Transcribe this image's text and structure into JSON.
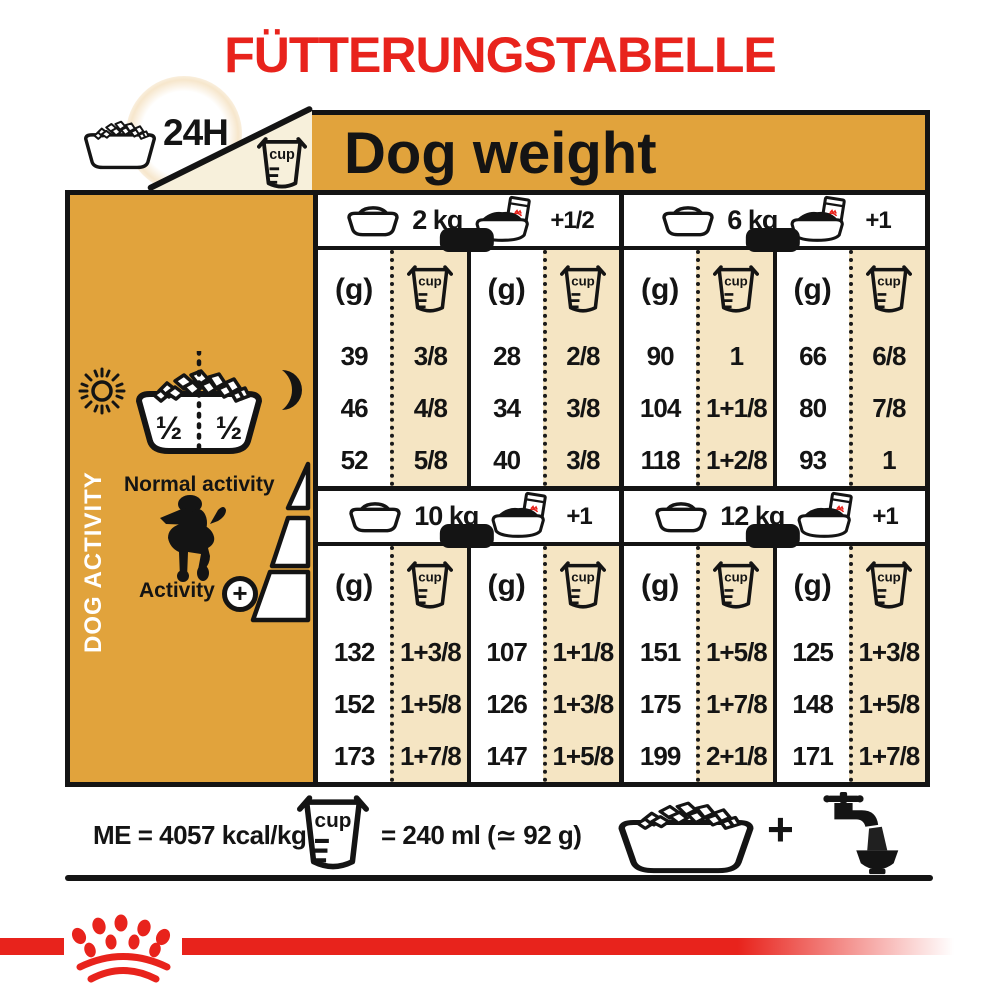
{
  "title": "FÜTTERUNGSTABELLE",
  "header": {
    "daily_label": "24H",
    "dog_weight_label": "Dog weight"
  },
  "icons": {
    "cup_text": "cup"
  },
  "sidebar": {
    "title": "DOG ACTIVITY",
    "bowl_half_left": "½",
    "bowl_half_right": "½",
    "normal_activity_label": "Normal activity",
    "activity_label": "Activity",
    "activity_plus": "+"
  },
  "table": {
    "grams_header": "(g)",
    "groups": [
      {
        "weight": "2 kg",
        "wet_add": "+1/2",
        "dry_g": [
          "39",
          "46",
          "52"
        ],
        "dry_cup": [
          "3/8",
          "4/8",
          "5/8"
        ],
        "mix_g": [
          "28",
          "34",
          "40"
        ],
        "mix_cup": [
          "2/8",
          "3/8",
          "3/8"
        ]
      },
      {
        "weight": "6 kg",
        "wet_add": "+1",
        "dry_g": [
          "90",
          "104",
          "118"
        ],
        "dry_cup": [
          "1",
          "1+1/8",
          "1+2/8"
        ],
        "mix_g": [
          "66",
          "80",
          "93"
        ],
        "mix_cup": [
          "6/8",
          "7/8",
          "1"
        ]
      },
      {
        "weight": "10 kg",
        "wet_add": "+1",
        "dry_g": [
          "132",
          "152",
          "173"
        ],
        "dry_cup": [
          "1+3/8",
          "1+5/8",
          "1+7/8"
        ],
        "mix_g": [
          "107",
          "126",
          "147"
        ],
        "mix_cup": [
          "1+1/8",
          "1+3/8",
          "1+5/8"
        ]
      },
      {
        "weight": "12 kg",
        "wet_add": "+1",
        "dry_g": [
          "151",
          "175",
          "199"
        ],
        "dry_cup": [
          "1+5/8",
          "1+7/8",
          "2+1/8"
        ],
        "mix_g": [
          "125",
          "148",
          "171"
        ],
        "mix_cup": [
          "1+3/8",
          "1+5/8",
          "1+7/8"
        ]
      }
    ]
  },
  "legend": {
    "me_label": "ME = 4057 kcal/kg",
    "cup_equiv_label": "= 240 ml (≃ 92 g)",
    "plus": "+"
  },
  "colors": {
    "brand_red": "#E8231C",
    "gold": "#E1A33C",
    "tan": "#F5E5C3",
    "cream": "#F7F0DB",
    "ink": "#141414"
  }
}
